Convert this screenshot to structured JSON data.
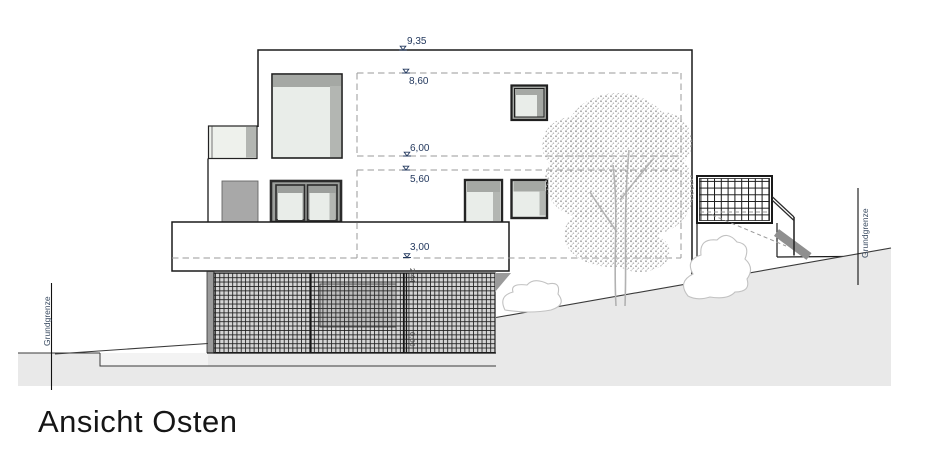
{
  "title": "Ansicht Osten",
  "boundaries": {
    "left_label": "Grundgrenze",
    "right_label": "Grundgrenze"
  },
  "levels": [
    {
      "label": "9,35"
    },
    {
      "label": "8,60"
    },
    {
      "label": "6,00"
    },
    {
      "label": "5,60"
    },
    {
      "label": "3,00"
    },
    {
      "label": "2,44"
    },
    {
      "label": "0,00"
    }
  ],
  "colors": {
    "glass": "#e9ede9",
    "frame_band": "#a5a8a4",
    "frame_strip": "#b3b6b2",
    "dark_frame": "#242424",
    "outline": "#1a1a1a",
    "door_panel": "#a8a8a8",
    "basement_wall": "#9b9b9b",
    "hatch_bg": "#d4d4d4",
    "terrain": "#e9e9e9",
    "terrain_light": "#f3f3f3",
    "stair": "#8f8f8f",
    "tree": "#a8a8a8",
    "dashed_line": "#9a9a9a",
    "dim_text": "#24395e",
    "sub_dim_text": "#4a4a4a",
    "boundary_text": "#3a4b61",
    "title_text": "#161616"
  }
}
